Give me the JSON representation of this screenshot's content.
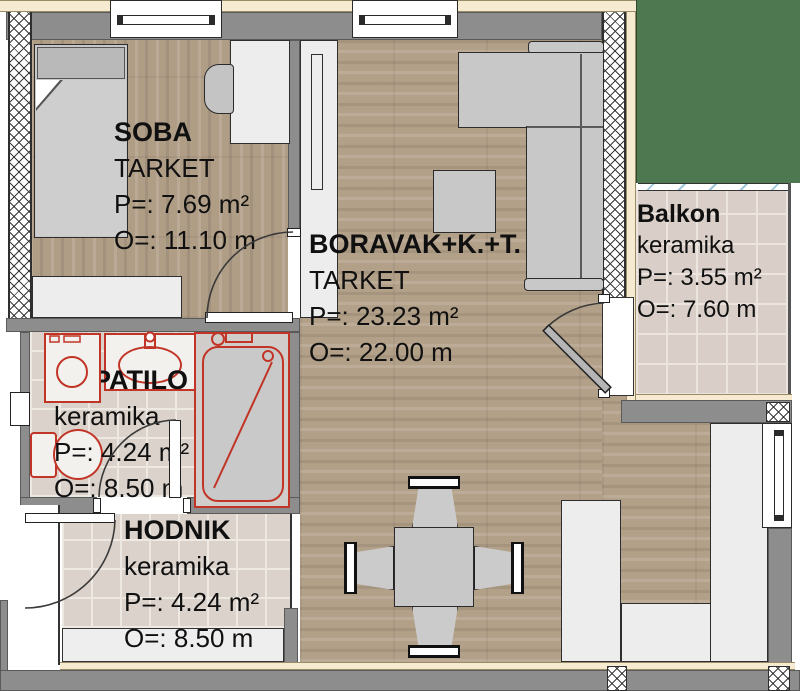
{
  "plan": {
    "title": "apartment-floor-plan",
    "rooms": [
      {
        "name": "SOBA",
        "floor": "TARKET",
        "area": "P=: 7.69 m²",
        "perimeter": "O=: 11.10 m"
      },
      {
        "name": "BORAVAK+K.+T.",
        "floor": "TARKET",
        "area": "P=: 23.23 m²",
        "perimeter": "O=: 22.00 m"
      },
      {
        "name": "KUPATILO",
        "floor": "keramika",
        "area": "P=: 4.24 m²",
        "perimeter": "O=: 8.50 m"
      },
      {
        "name": "HODNIK",
        "floor": "keramika",
        "area": "P=: 4.24 m²",
        "perimeter": "O=: 8.50 m"
      },
      {
        "name": "Balkon",
        "floor": "keramika",
        "area": "P=: 3.55 m²",
        "perimeter": "O=: 7.60 m"
      }
    ],
    "colors": {
      "wood_floor": "#b3a089",
      "ceramic_tile": "#dbd2cb",
      "wall_gray": "#8d8d8d",
      "facade_cream": "#f6ebd1",
      "grass_green": "#4d7850",
      "fixture_red": "#c13527",
      "furniture_gray": "#c8c8c8"
    }
  }
}
